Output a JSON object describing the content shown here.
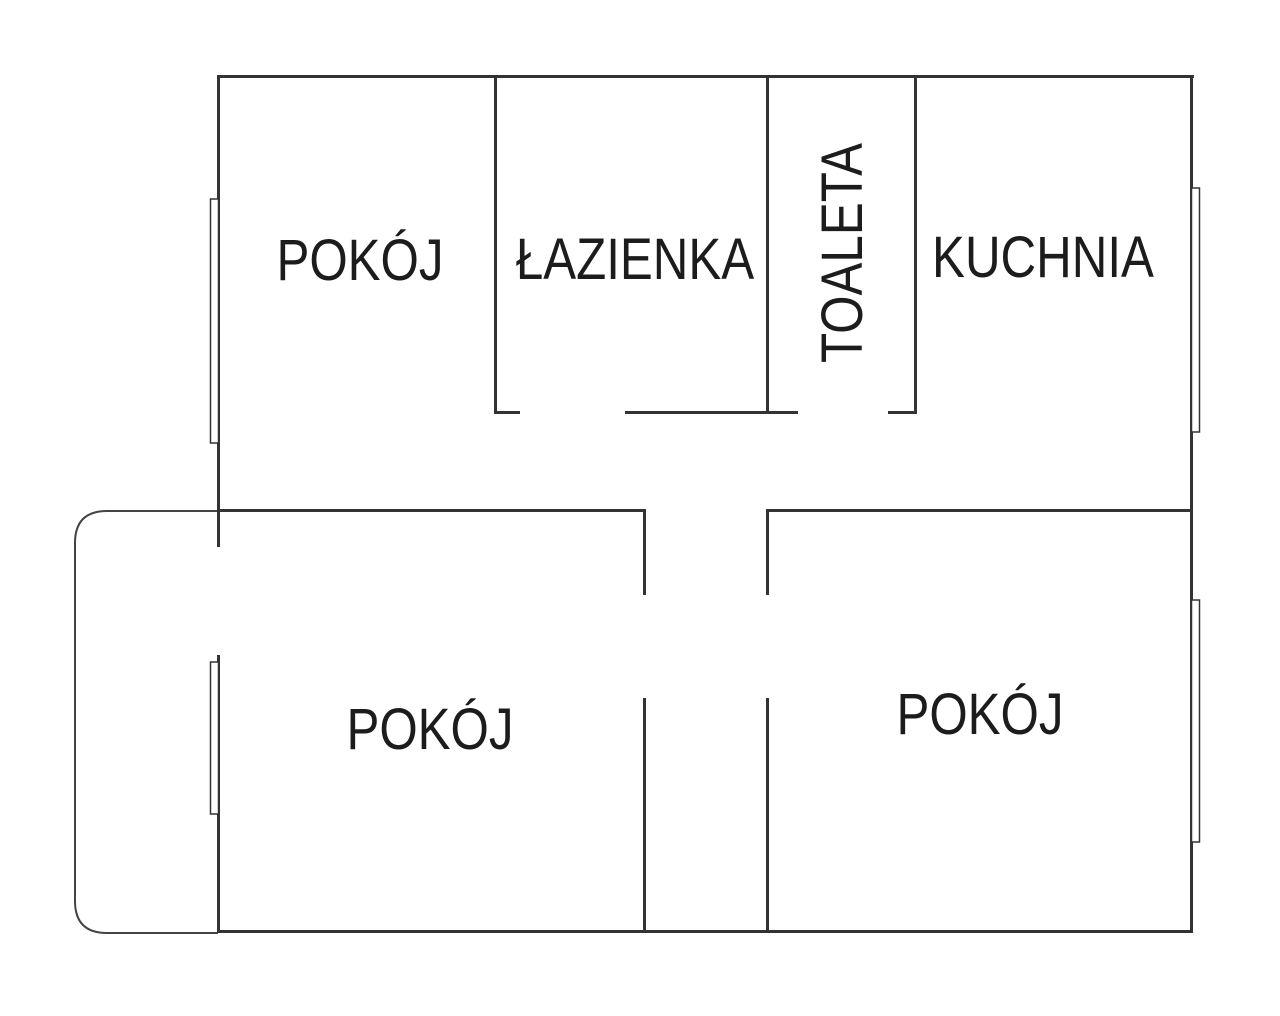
{
  "rooms": [
    {
      "id": "room-top-left",
      "label": "POKÓJ"
    },
    {
      "id": "bathroom",
      "label": "ŁAZIENKA"
    },
    {
      "id": "toilet",
      "label": "TOALETA"
    },
    {
      "id": "kitchen",
      "label": "KUCHNIA"
    },
    {
      "id": "room-bottom-left",
      "label": "POKÓJ"
    },
    {
      "id": "room-bottom-right",
      "label": "POKÓJ"
    }
  ],
  "colors": {
    "wall": "#333333",
    "text": "#1c1c1c",
    "background": "#ffffff"
  }
}
